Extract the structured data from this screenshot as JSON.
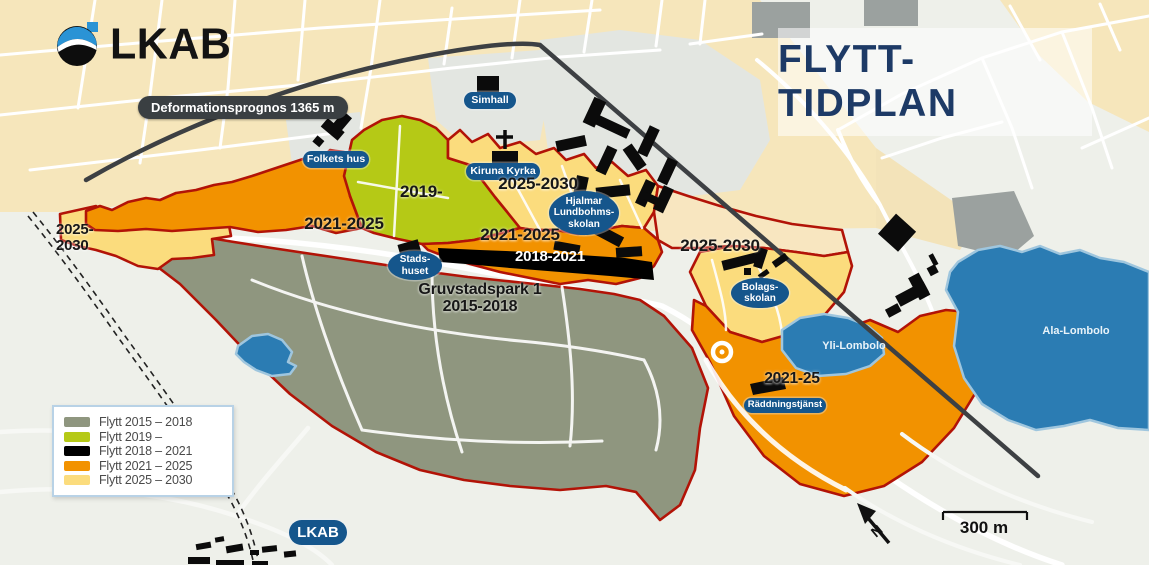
{
  "title": "FLYTT-TIDPLAN",
  "logo": {
    "text": "LKAB"
  },
  "annotations": {
    "deformation": "Deformationsprognos 1365 m"
  },
  "legend": {
    "items": [
      {
        "label": "Flytt 2015 – 2018",
        "color": "#8f967f"
      },
      {
        "label": "Flytt 2019 –",
        "color": "#b5c916"
      },
      {
        "label": "Flytt 2018 – 2021",
        "color": "#000000"
      },
      {
        "label": "Flytt 2021 – 2025",
        "color": "#f29200"
      },
      {
        "label": "Flytt 2025 – 2030",
        "color": "#fbdc7d"
      }
    ]
  },
  "places": {
    "folkets_hus": "Folkets hus",
    "simhall": "Simhall",
    "kiruna_kyrka": "Kiruna Kyrka",
    "hjalmar": "Hjalmar\nLundbohms-\nskolan",
    "stadshuset": "Stads-\nhuset",
    "bolagsskolan": "Bolags-\nskolan",
    "raddningstjanst": "Räddningstjänst",
    "lkab_site": "LKAB",
    "yli_lombolo": "Yli-Lombolo",
    "ala_lombolo": "Ala-Lombolo"
  },
  "zones": {
    "far_west": "2025-\n2030",
    "west": "2021-2025",
    "green": "2019-",
    "church": "2025-2030",
    "center": "2021-2025",
    "black_band": "2018-2021",
    "east": "2025-2030",
    "south": "2021-25",
    "gruvstadspark": "Gruvstadspark 1\n2015-2018"
  },
  "map": {
    "north_label": "N",
    "scale_label": "300 m"
  },
  "colors": {
    "zone_border": "#b21307",
    "orange": "#f29200",
    "yellow": "#fbdc7d",
    "green": "#b5c916",
    "park_green": "#8f967f",
    "black_zone": "#000000",
    "lake_blue": "#2b7cb3",
    "pill_blue": "#15568c",
    "title_navy": "#1d3a66",
    "cream": "#f6e6bb"
  }
}
